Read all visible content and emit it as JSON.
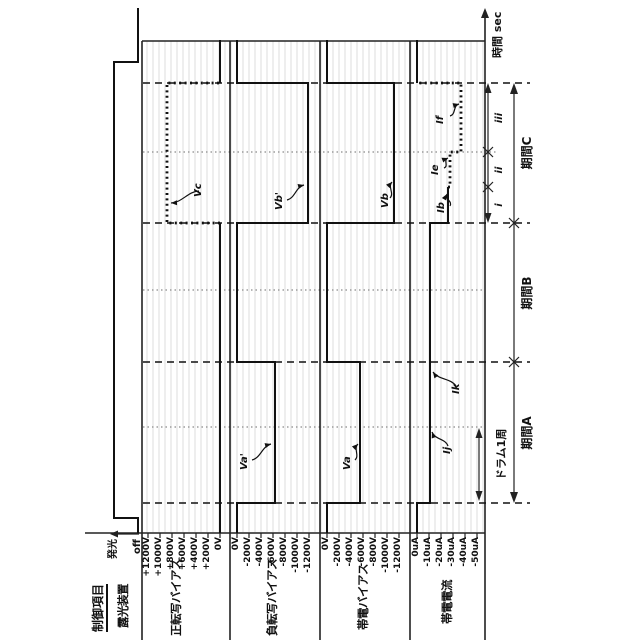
{
  "header": {
    "control_item": "制御項目",
    "time_axis_label": "時間 sec"
  },
  "rows": [
    {
      "label": "露光装置",
      "scale": [
        "発光",
        "off"
      ]
    },
    {
      "label": "正転写バイアス",
      "scale": [
        "+1200V",
        "+1000V",
        "+800V",
        "+600V",
        "+400V",
        "+200V",
        "0V"
      ]
    },
    {
      "label": "負転写バイアス",
      "scale": [
        "0V",
        "-200V",
        "-400V",
        "-600V",
        "-800V",
        "-1000V",
        "-1200V"
      ]
    },
    {
      "label": "帯電バイアス",
      "scale": [
        "0V",
        "-200V",
        "-400V",
        "-600V",
        "-800V",
        "-1000V",
        "-1200V"
      ]
    },
    {
      "label": "帯電電流",
      "scale": [
        "0uA",
        "-10uA",
        "-20uA",
        "-30uA",
        "-40uA",
        "-50uA"
      ]
    }
  ],
  "periods": {
    "a": "期間A",
    "b": "期間B",
    "c": "期間C",
    "drum": "ドラム1周",
    "sub_i": "i",
    "sub_ii": "ii",
    "sub_iii": "iii"
  },
  "annotations": {
    "vc": "Vc",
    "va_p": "Va'",
    "vb_p": "Vb'",
    "va": "Va",
    "vb": "Vb",
    "ij": "Ij",
    "ik": "Ik",
    "ib": "Ib",
    "ie": "Ie",
    "if": "If"
  },
  "chart_data": {
    "type": "timing",
    "time_axis": {
      "label": "時間 sec",
      "direction": "right"
    },
    "orientation_note": "entire landscape chart rotated 90deg counter-clockwise in screenshot",
    "plot": {
      "left": 107,
      "right": 600,
      "top": 85,
      "bottom": 485,
      "grid_step": 6
    },
    "boundaries": {
      "dashed_px": [
        137,
        278,
        417,
        557
      ],
      "dotted_px": [
        213,
        350,
        488
      ]
    },
    "periods": [
      {
        "name": "期間A",
        "start_px": 137,
        "end_px": 278,
        "sub": [
          {
            "name": "ドラム1周",
            "start_px": 137,
            "end_px": 213
          }
        ]
      },
      {
        "name": "期間B",
        "start_px": 278,
        "end_px": 417
      },
      {
        "name": "期間C",
        "start_px": 417,
        "end_px": 557,
        "sub": [
          {
            "name": "i",
            "start_px": 417,
            "end_px": 453
          },
          {
            "name": "ii",
            "start_px": 453,
            "end_px": 488
          },
          {
            "name": "iii",
            "start_px": 488,
            "end_px": 557
          }
        ]
      }
    ],
    "channels": [
      {
        "name": "露光装置",
        "type": "binary",
        "levels": [
          "発光",
          "off"
        ],
        "timeline": [
          {
            "phase": "before start",
            "value": "off"
          },
          {
            "phase": "start → just after 期間C",
            "value": "発光"
          },
          {
            "phase": "end",
            "value": "off"
          }
        ]
      },
      {
        "name": "正転写バイアス",
        "unit": "V",
        "range": [
          0,
          1200
        ],
        "timeline": [
          {
            "phase": "期間A+期間B",
            "value": "0V"
          },
          {
            "phase": "期間C",
            "value": "Vc",
            "approx": 880,
            "style": "dotted"
          },
          {
            "phase": "after 期間C",
            "value": "0V"
          }
        ]
      },
      {
        "name": "負転写バイアス",
        "unit": "V",
        "range": [
          0,
          -1200
        ],
        "timeline": [
          {
            "phase": "期間A",
            "value": "Va'",
            "approx": -600
          },
          {
            "phase": "期間B",
            "value": "0V"
          },
          {
            "phase": "期間C",
            "value": "Vb'",
            "approx": -1180
          },
          {
            "phase": "after 期間C",
            "value": "0V"
          }
        ]
      },
      {
        "name": "帯電バイアス",
        "unit": "V",
        "range": [
          0,
          -1200
        ],
        "timeline": [
          {
            "phase": "期間A",
            "value": "Va",
            "approx": -550
          },
          {
            "phase": "期間B",
            "value": "0V"
          },
          {
            "phase": "期間C",
            "value": "Vb",
            "approx": -1120
          },
          {
            "phase": "after 期間C",
            "value": "0V"
          }
        ]
      },
      {
        "name": "帯電電流",
        "unit": "uA",
        "range": [
          0,
          -50
        ],
        "timeline": [
          {
            "phase": "期間A (ドラム1周=Ij, then Ik)",
            "value": "Ij/Ik",
            "approx": -11
          },
          {
            "phase": "期間B",
            "value": "Ik",
            "approx": -11
          },
          {
            "phase": "期間C i",
            "value": "Ib",
            "approx": -26
          },
          {
            "phase": "期間C ii",
            "value": "Ie",
            "approx": -27,
            "style": "dotted"
          },
          {
            "phase": "期間C iii",
            "value": "If",
            "approx": -37,
            "style": "dotted"
          },
          {
            "phase": "after 期間C",
            "value": "0uA"
          }
        ]
      }
    ],
    "waveforms": [
      {
        "name": "exposure",
        "style": "solid",
        "points": [
          [
            107,
            138
          ],
          [
            122,
            138
          ],
          [
            122,
            114
          ],
          [
            578,
            114
          ],
          [
            578,
            138
          ],
          [
            632,
            138
          ]
        ]
      },
      {
        "name": "pos-transfer-base1",
        "style": "solid",
        "points": [
          [
            107,
            220
          ],
          [
            417,
            220
          ]
        ]
      },
      {
        "name": "pos-transfer-vc-pulse",
        "style": "dotted",
        "points": [
          [
            417,
            220
          ],
          [
            417,
            167
          ],
          [
            557,
            167
          ],
          [
            557,
            220
          ]
        ]
      },
      {
        "name": "pos-transfer-base2",
        "style": "solid",
        "points": [
          [
            557,
            220
          ],
          [
            600,
            220
          ]
        ]
      },
      {
        "name": "neg-transfer",
        "style": "solid",
        "points": [
          [
            107,
            237
          ],
          [
            137,
            237
          ],
          [
            137,
            275
          ],
          [
            278,
            275
          ],
          [
            278,
            237
          ],
          [
            417,
            237
          ],
          [
            417,
            308
          ],
          [
            557,
            308
          ],
          [
            557,
            237
          ],
          [
            600,
            237
          ]
        ]
      },
      {
        "name": "charge-bias",
        "style": "solid",
        "points": [
          [
            107,
            327
          ],
          [
            137,
            327
          ],
          [
            137,
            360
          ],
          [
            278,
            360
          ],
          [
            278,
            327
          ],
          [
            417,
            327
          ],
          [
            417,
            394
          ],
          [
            557,
            394
          ],
          [
            557,
            327
          ],
          [
            600,
            327
          ]
        ]
      },
      {
        "name": "charge-current-main",
        "style": "solid",
        "points": [
          [
            107,
            417
          ],
          [
            137,
            417
          ],
          [
            137,
            430
          ],
          [
            417,
            430
          ],
          [
            417,
            448
          ],
          [
            453,
            448
          ]
        ]
      },
      {
        "name": "charge-current-dotted",
        "style": "dotted",
        "points": [
          [
            453,
            448
          ],
          [
            453,
            450
          ],
          [
            488,
            450
          ],
          [
            488,
            461
          ],
          [
            557,
            461
          ],
          [
            557,
            418
          ]
        ]
      },
      {
        "name": "charge-current-end",
        "style": "solid",
        "points": [
          [
            557,
            417
          ],
          [
            600,
            417
          ]
        ]
      }
    ]
  }
}
